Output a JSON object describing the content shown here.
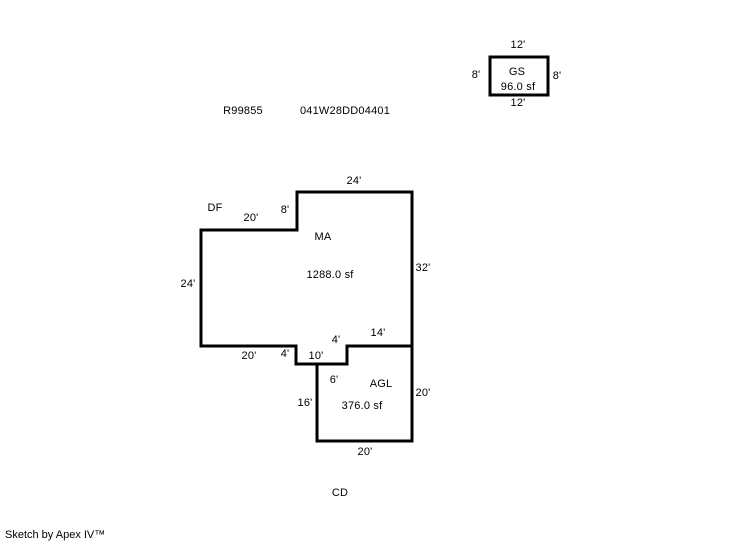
{
  "header": {
    "record_id": "R99855",
    "parcel_id": "041W28DD04401"
  },
  "gs": {
    "name": "GS",
    "area": "96.0 sf",
    "top_dim": "12'",
    "bottom_dim": "12'",
    "left_dim": "8'",
    "right_dim": "8'"
  },
  "df": {
    "name": "DF"
  },
  "ma": {
    "name": "MA",
    "area": "1288.0 sf",
    "top_dim": "24'",
    "right_dim": "32'",
    "left_dim": "24'",
    "upper_left_dim": "20'",
    "upper_step_dim": "8'",
    "bottom_left_dim": "20'",
    "bottom_right_dim": "14'",
    "notch_left_dim": "4'",
    "notch_right_dim": "4'",
    "notch_bottom_dim": "10'"
  },
  "agl": {
    "name": "AGL",
    "area": "376.0 sf",
    "notch_dim": "6'",
    "left_dim": "16'",
    "right_dim": "20'",
    "bottom_dim": "20'"
  },
  "cd": {
    "name": "CD"
  },
  "footer": {
    "credit": "Sketch by Apex IV™"
  },
  "colors": {
    "line": "#000000",
    "background": "#ffffff"
  }
}
